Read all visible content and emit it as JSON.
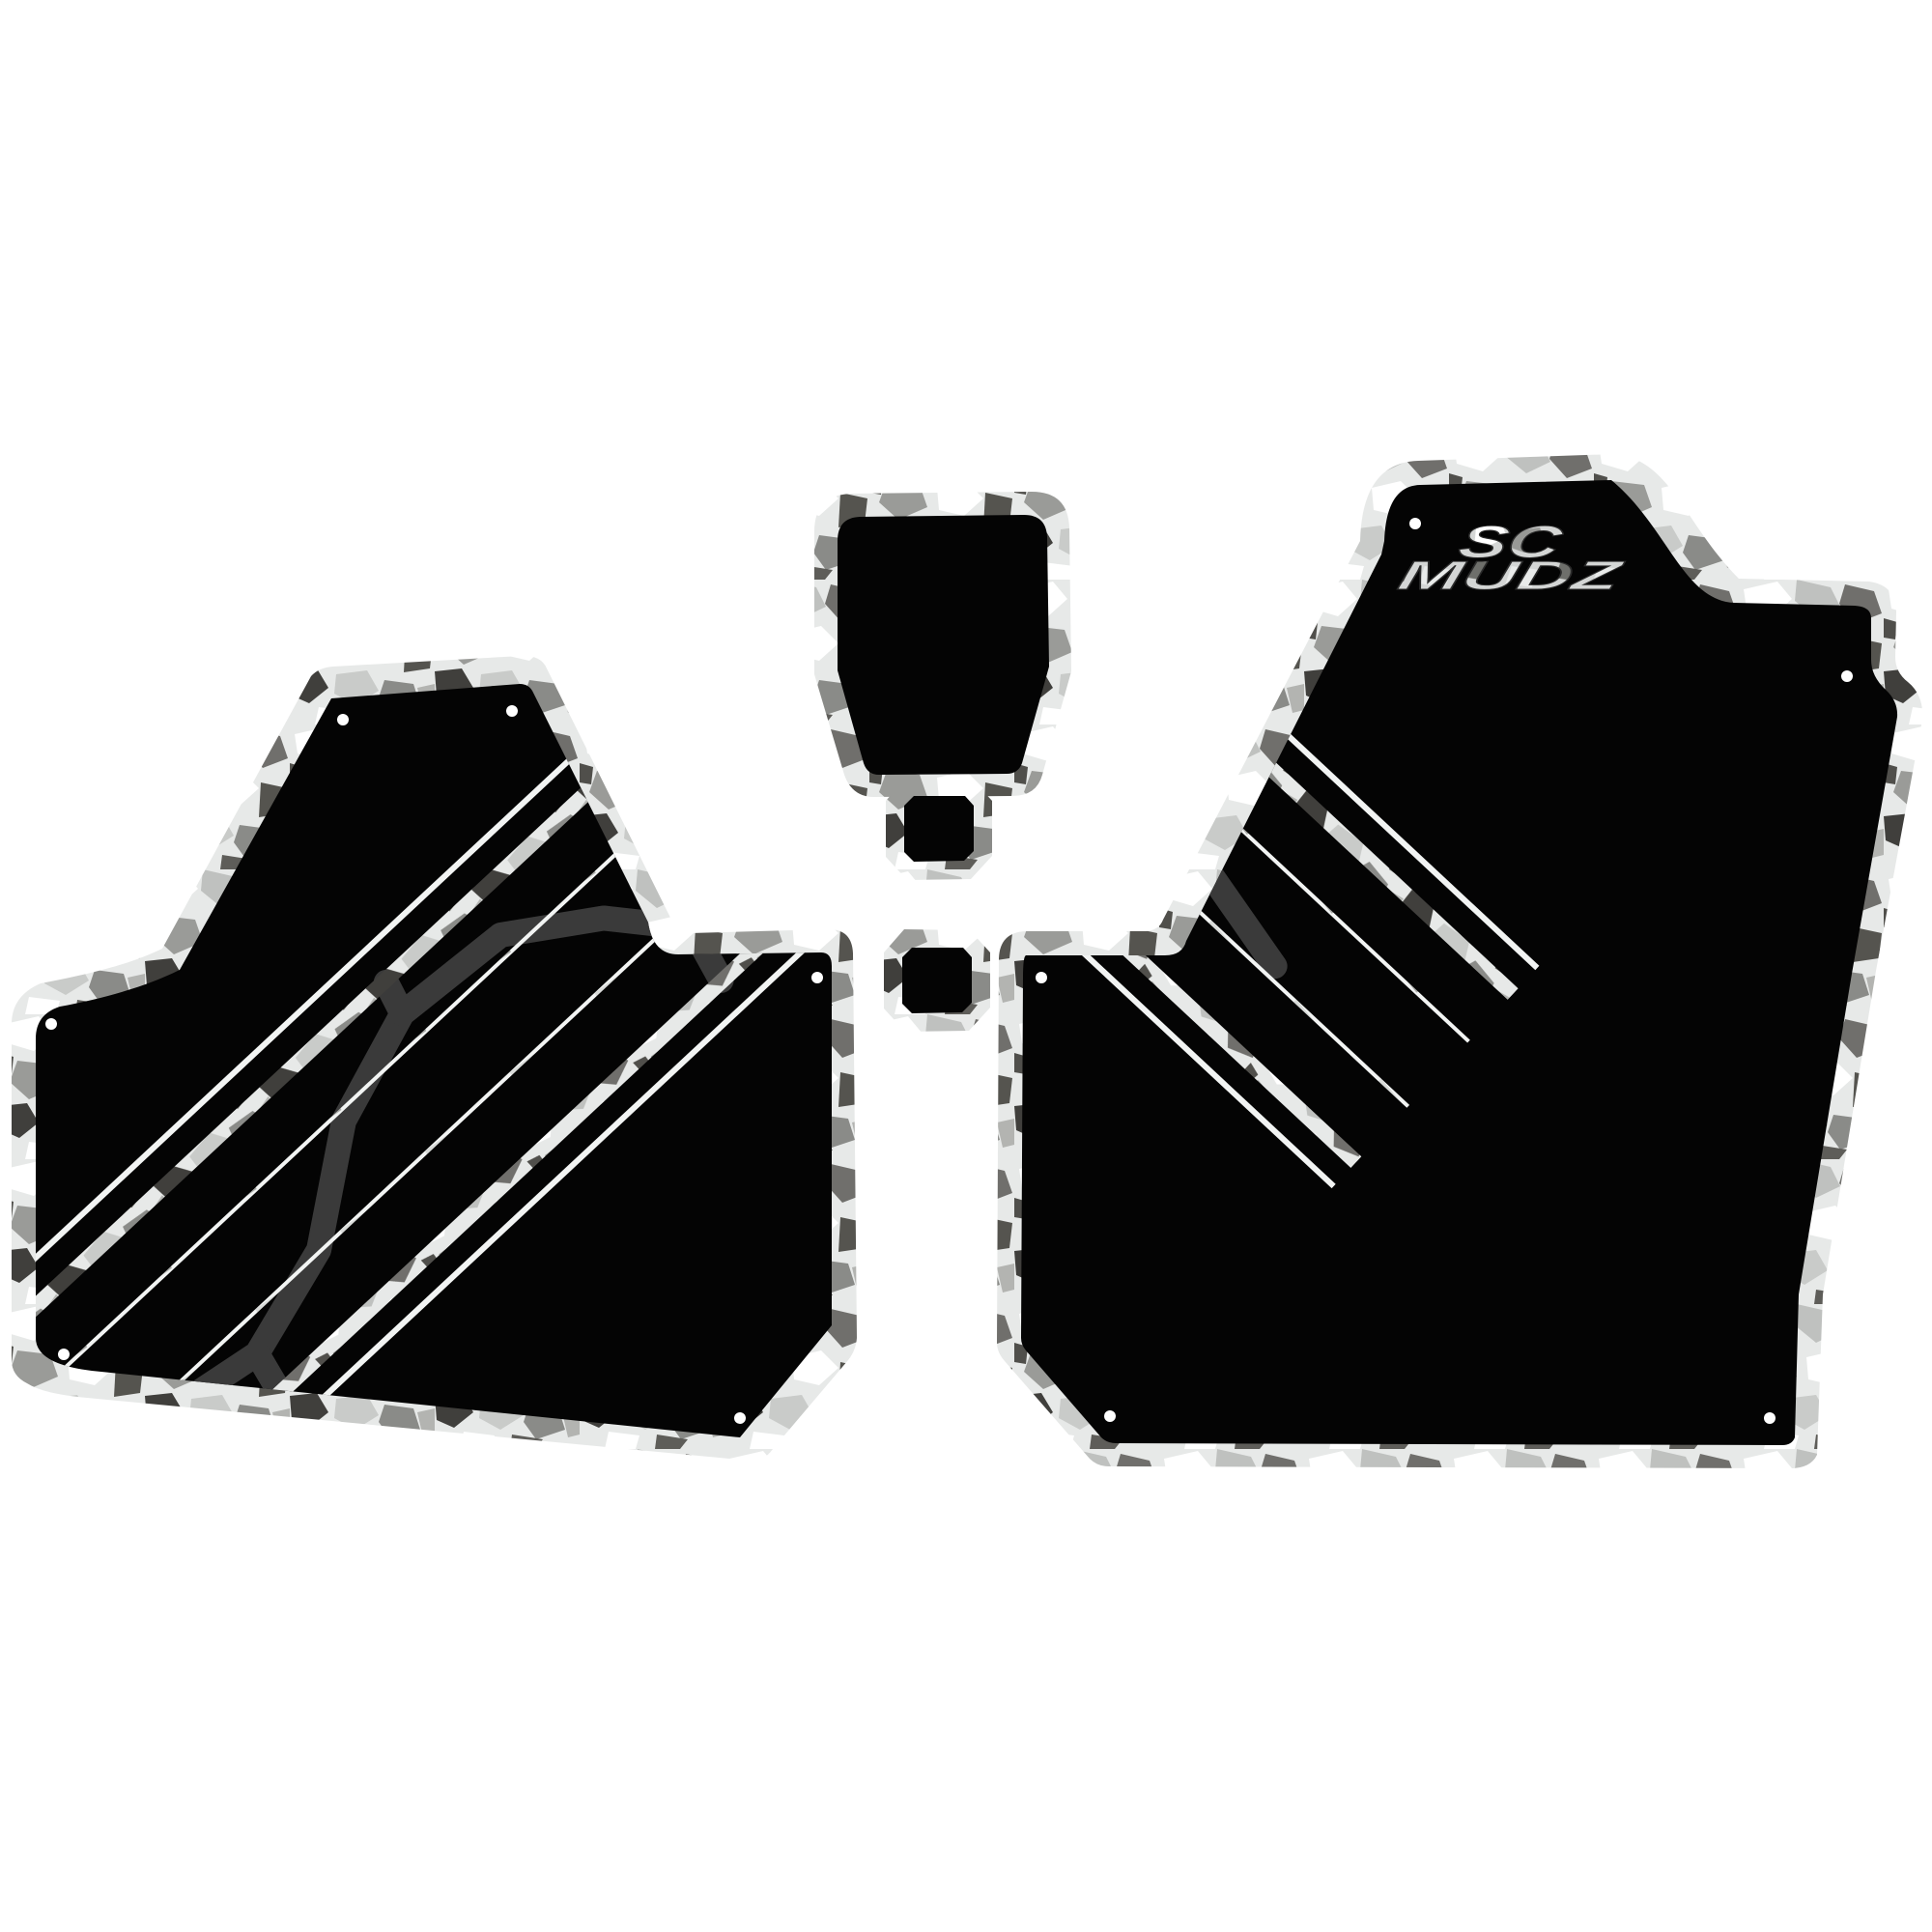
{
  "product": {
    "logo": {
      "line1": "SC",
      "line2": "MUDZ"
    },
    "caption": "Two-door UTV decal kit, black panels with snow-camo borders and diagonal web stripe",
    "pieces": [
      {
        "name": "left-door-panel-decal"
      },
      {
        "name": "center-pod-decal"
      },
      {
        "name": "octagon-grommet-top"
      },
      {
        "name": "octagon-grommet-bottom"
      },
      {
        "name": "right-door-panel-decal"
      }
    ],
    "colors": {
      "background": "#ffffff",
      "panel_black": "#040404",
      "web_gray": "#3a3a3a",
      "camo_base": "#e7e9e8",
      "camo_mid": "#8f908e",
      "camo_dark": "#4a4946",
      "pinstripe": "#f2f4f3"
    }
  }
}
